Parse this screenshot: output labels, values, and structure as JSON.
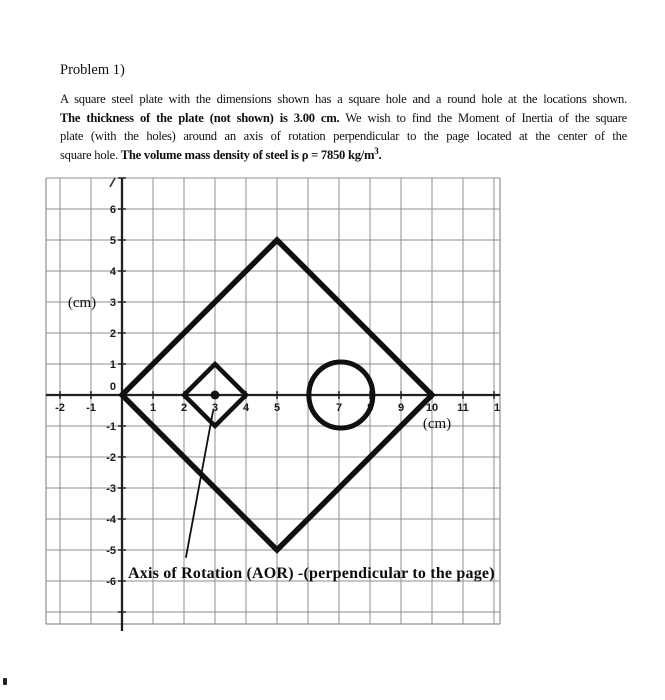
{
  "page": {
    "title": "Problem 1)",
    "paragraph_lines": [
      [
        {
          "t": "A square steel plate with the dimensions shown has a square hole and a round hole at the locations shown.",
          "b": 0
        }
      ],
      [
        {
          "t": "The thickness of the plate (not shown) is 3.00 cm.",
          "b": 1
        },
        {
          "t": " We wish to find the Moment of Inertia of the square",
          "b": 0
        }
      ],
      [
        {
          "t": "plate (with the holes) around an axis of rotation perpendicular to the page located at the center of the",
          "b": 0
        }
      ],
      [
        {
          "t": "square hole. ",
          "b": 0
        },
        {
          "t": "The volume mass density of steel is ρ = 7850 kg/m",
          "b": 1
        },
        {
          "t": "3",
          "b": 1,
          "sup": 1
        },
        {
          "t": ".",
          "b": 1
        }
      ]
    ]
  },
  "figure": {
    "unit_px": 31,
    "origin_px": {
      "x": 122,
      "y": 395
    },
    "grid": {
      "x_min": -2,
      "x_max": 12,
      "y_min": -7,
      "y_max": 7,
      "left_px": 46,
      "right_px": 500,
      "top_px": 178,
      "bottom_px": 624,
      "color": "#8f8f8f"
    },
    "colors": {
      "axis": "#1f1f1f",
      "shape": "#101010"
    },
    "x_tick_labels": [
      {
        "x": -2,
        "t": "-2"
      },
      {
        "x": -1,
        "t": "-1"
      },
      {
        "x": 1,
        "t": "1"
      },
      {
        "x": 2,
        "t": "2"
      },
      {
        "x": 3,
        "t": "3"
      },
      {
        "x": 4,
        "t": "4"
      },
      {
        "x": 5,
        "t": "5"
      },
      {
        "x": 7,
        "t": "7"
      },
      {
        "x": 8,
        "t": "8"
      },
      {
        "x": 9,
        "t": "9"
      },
      {
        "x": 10,
        "t": "10"
      },
      {
        "x": 11,
        "t": "11"
      },
      {
        "x": 12,
        "t": "1",
        "dx": 3
      }
    ],
    "y_tick_labels": [
      {
        "y": 6,
        "t": "6"
      },
      {
        "y": 5,
        "t": "5"
      },
      {
        "y": 4,
        "t": "4"
      },
      {
        "y": 3,
        "t": "3"
      },
      {
        "y": 2,
        "t": "2"
      },
      {
        "y": 1,
        "t": "1"
      },
      {
        "y": 0,
        "t": "0",
        "dy": -9
      },
      {
        "y": -1,
        "t": "-1"
      },
      {
        "y": -2,
        "t": "-2"
      },
      {
        "y": -3,
        "t": "-3"
      },
      {
        "y": -4,
        "t": "-4"
      },
      {
        "y": -5,
        "t": "-5"
      },
      {
        "y": -6,
        "t": "-6"
      }
    ],
    "x_unit_label": {
      "t": "(cm)",
      "x_px": 437,
      "y_px": 428
    },
    "y_unit_label": {
      "t": "(cm)",
      "x_px": 82,
      "y_px": 307
    },
    "caption": {
      "t": "Axis of Rotation (AOR) -(perpendicular to the page)",
      "x_px": 128,
      "y_px": 578
    },
    "shapes": {
      "outer_plate": {
        "points": [
          [
            0,
            0
          ],
          [
            5,
            5
          ],
          [
            10,
            0
          ],
          [
            5,
            -5
          ]
        ],
        "stroke_px": 5.5
      },
      "square_hole": {
        "points": [
          [
            2,
            0
          ],
          [
            3,
            1
          ],
          [
            4,
            0
          ],
          [
            3,
            -1
          ]
        ],
        "stroke_px": 4.5
      },
      "round_hole": {
        "cx": 7.06,
        "cy": 0,
        "rx_px": 32,
        "ry_px": 33,
        "stroke_px": 5
      },
      "aor_center_dot": {
        "x": 3,
        "y": 0,
        "r_px": 4.5
      },
      "leader_line": {
        "x1": 2.94,
        "y1": -0.5,
        "x2": 2.06,
        "y2": -5.25,
        "stroke_px": 1.8
      }
    },
    "artifacts": {
      "clipped_top_label": {
        "x1": 115,
        "y1": 178,
        "x2": 110,
        "y2": 187
      },
      "page_speck": {
        "x": 3,
        "y": 678,
        "w": 4,
        "h": 7
      }
    }
  }
}
